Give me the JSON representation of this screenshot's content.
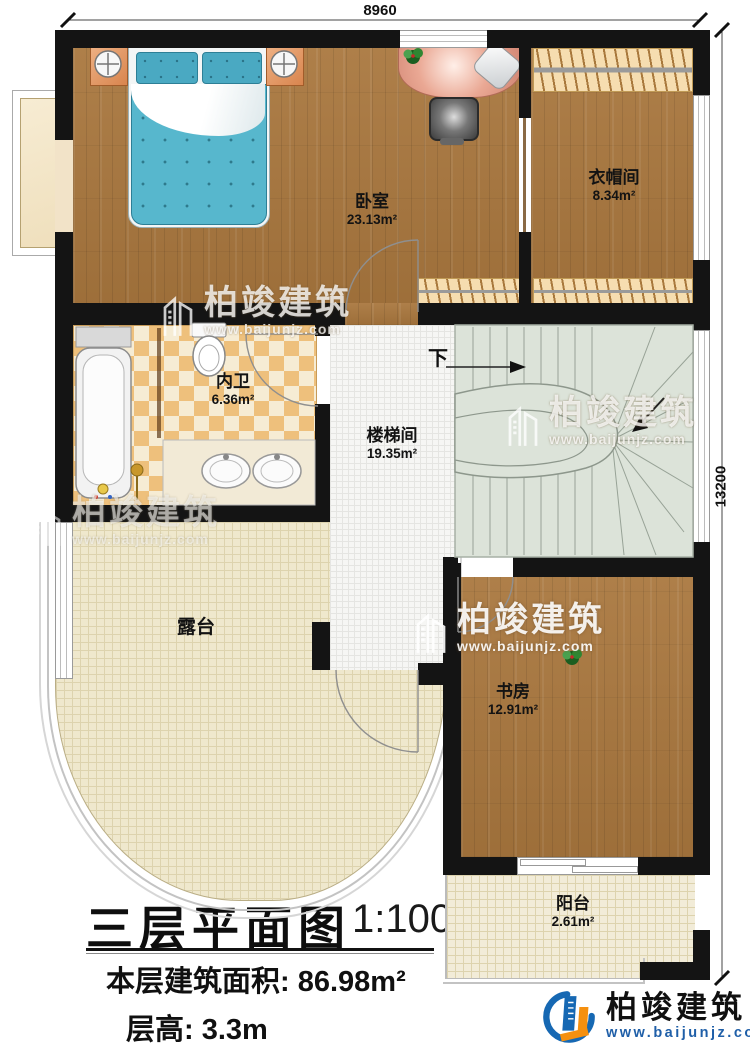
{
  "dimensions": {
    "top": "8960",
    "right": "13200"
  },
  "plan": {
    "rooms": [
      {
        "name": "卧室",
        "area": "23.13m²"
      },
      {
        "name": "衣帽间",
        "area": "8.34m²"
      },
      {
        "name": "内卫",
        "area": "6.36m²"
      },
      {
        "name": "楼梯间",
        "area": "19.35m²"
      },
      {
        "name": "书房",
        "area": "12.91m²"
      },
      {
        "name": "露台",
        "area": ""
      },
      {
        "name": "阳台",
        "area": "2.61m²"
      }
    ],
    "stair_down_label": "下"
  },
  "title_block": {
    "title": "三层平面图",
    "scale": "1:100",
    "area_label": "本层建筑面积:",
    "area_value": "86.98m²",
    "floor_height_label": "层高:",
    "floor_height_value": "3.3m"
  },
  "brand": {
    "name": "柏竣建筑",
    "url": "www.baijunjz.com"
  },
  "colors": {
    "wall": "#141414",
    "wood": "#a9773e",
    "stair": "#dce3d9",
    "tile_a": "#eec07c",
    "tile_b": "#f6ecd4",
    "brand_blue": "#1668b3",
    "brand_orange": "#f5900f"
  }
}
